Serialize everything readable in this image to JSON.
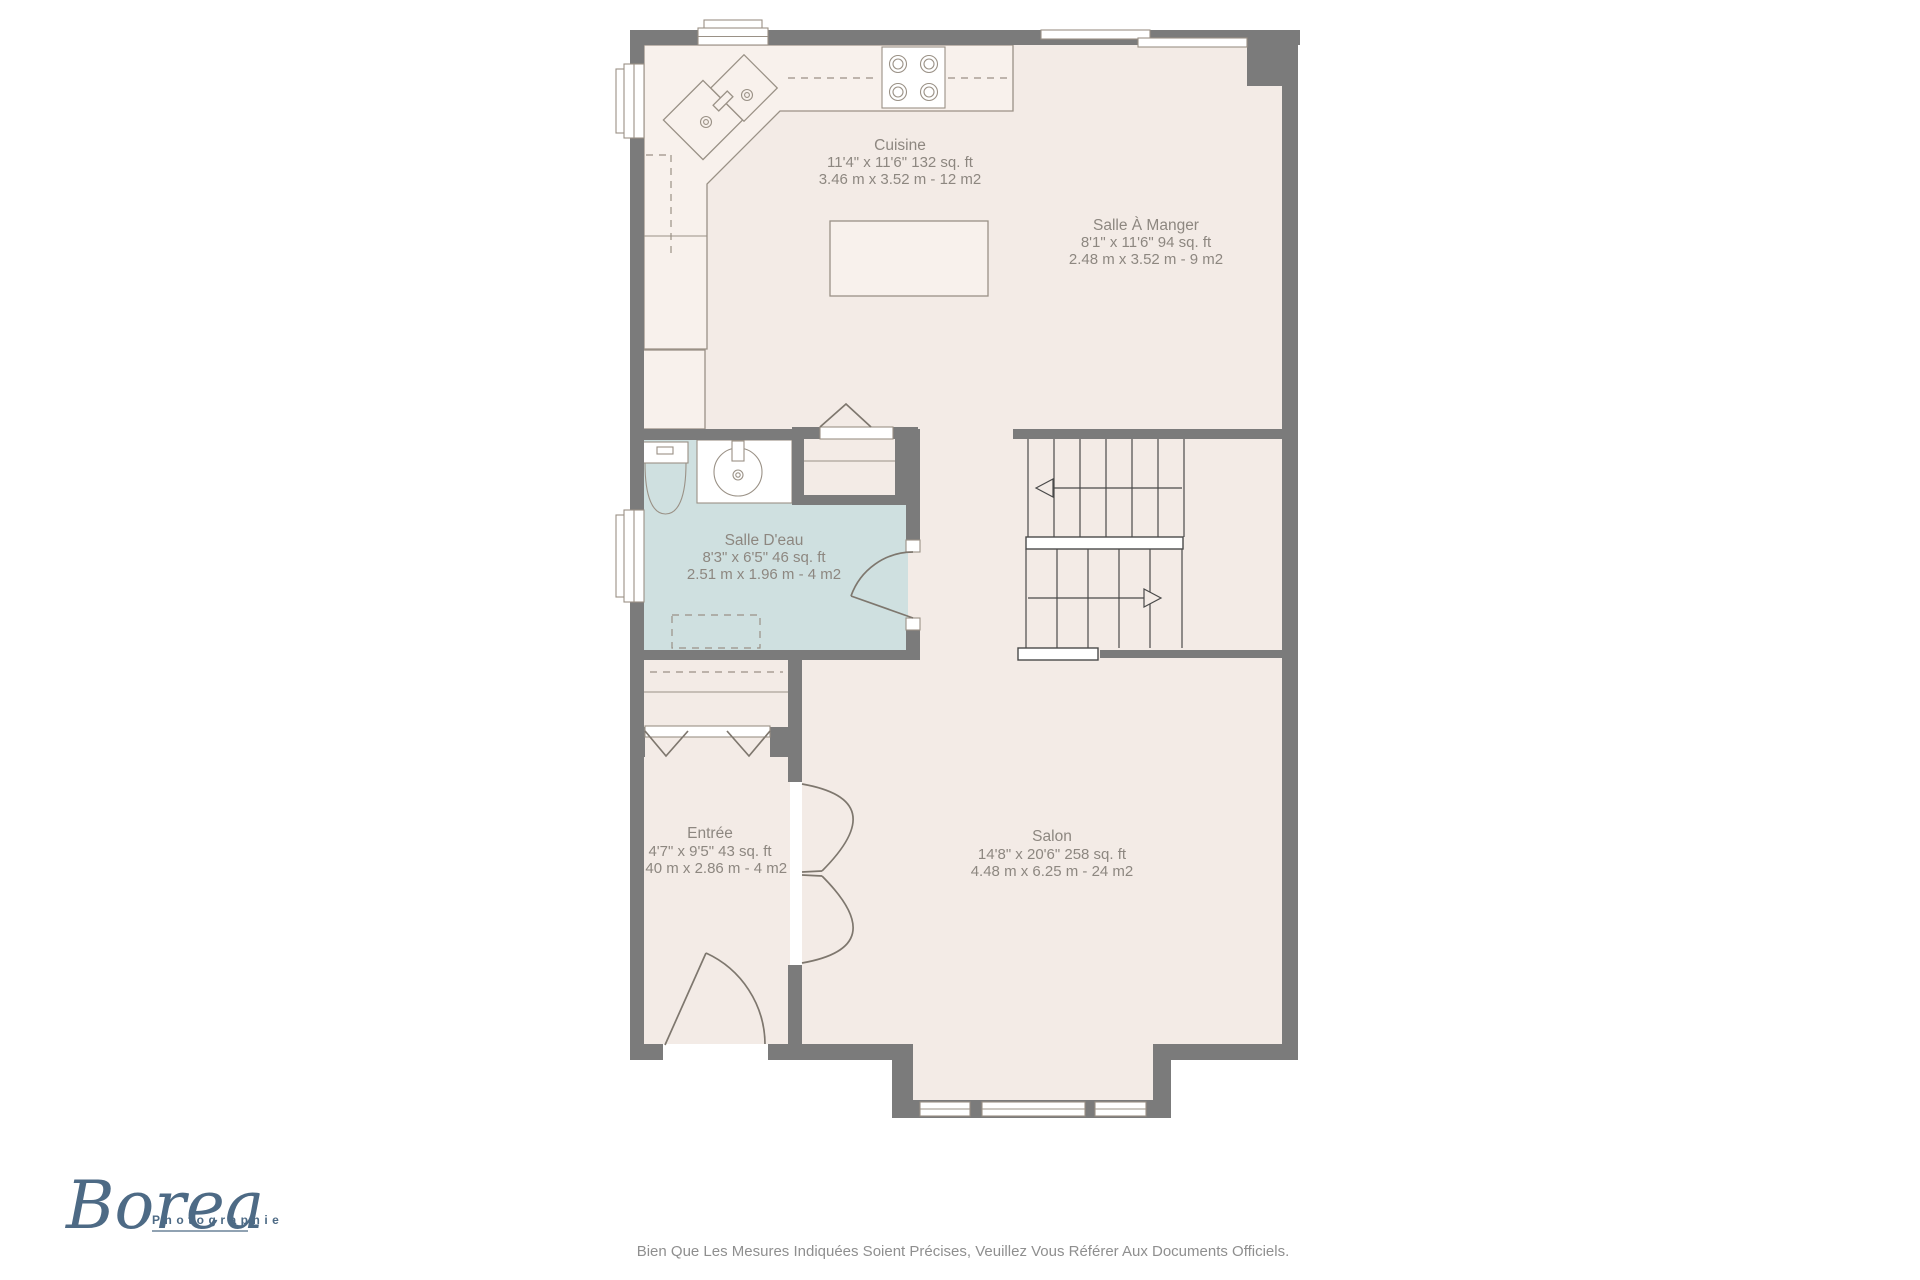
{
  "floor_plan": {
    "rooms": {
      "cuisine": {
        "name": "Cuisine",
        "imperial": "11'4\" x 11'6\" 132 sq. ft",
        "metric": "3.46 m x 3.52 m - 12 m2"
      },
      "salle_a_manger": {
        "name": "Salle À Manger",
        "imperial": "8'1\" x 11'6\" 94 sq. ft",
        "metric": "2.48 m x 3.52 m - 9 m2"
      },
      "salle_deau": {
        "name": "Salle D'eau",
        "imperial": "8'3\" x 6'5\" 46 sq. ft",
        "metric": "2.51 m x 1.96 m - 4 m2"
      },
      "entree": {
        "name": "Entrée",
        "imperial": "4'7\" x 9'5\" 43 sq. ft",
        "metric": "1.40 m x 2.86 m - 4 m2"
      },
      "salon": {
        "name": "Salon",
        "imperial": "14'8\" x 20'6\" 258 sq. ft",
        "metric": "4.48 m x 6.25 m - 24 m2"
      }
    }
  },
  "branding": {
    "logo_text": "Borea",
    "logo_subtext": "Photographie"
  },
  "disclaimer": {
    "text": "Bien Que Les Mesures Indiquées Soient Précises, Veuillez Vous Référer Aux Documents Officiels."
  },
  "colors": {
    "wall": "#7b7b7b",
    "floor": "#f3ebe6",
    "bathroom": "#cfe0e0",
    "label_text": "#8d8780",
    "logo": "#4d6a85",
    "disclaimer_text": "#8f8f8f"
  }
}
